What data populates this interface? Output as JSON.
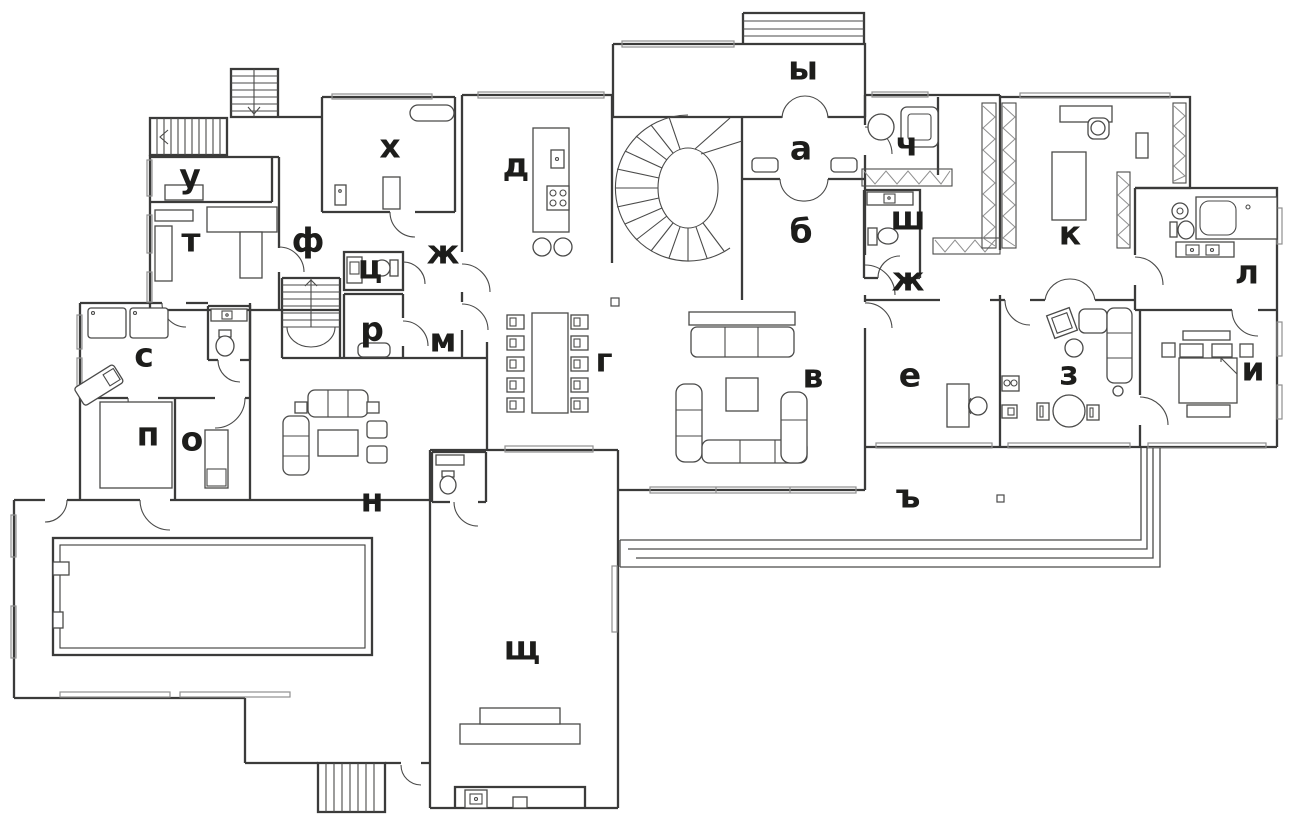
{
  "style": {
    "background": "#ffffff",
    "wall_color": "#3b3b3a",
    "furniture_color": "#4a4a49",
    "window_color": "#8f8f8f",
    "label_color": "#1d1d1b",
    "label_font_size": "33px"
  },
  "plan_type": "floor-plan",
  "rooms": [
    {
      "letter": "ы",
      "x": 803,
      "y": 68
    },
    {
      "letter": "а",
      "x": 801,
      "y": 148
    },
    {
      "letter": "б",
      "x": 801,
      "y": 231
    },
    {
      "letter": "ч",
      "x": 907,
      "y": 144
    },
    {
      "letter": "ш",
      "x": 908,
      "y": 218
    },
    {
      "letter": "ж",
      "x": 908,
      "y": 279
    },
    {
      "letter": "к",
      "x": 1070,
      "y": 233
    },
    {
      "letter": "л",
      "x": 1247,
      "y": 272
    },
    {
      "letter": "х",
      "x": 390,
      "y": 146
    },
    {
      "letter": "д",
      "x": 516,
      "y": 165
    },
    {
      "letter": "у",
      "x": 190,
      "y": 176
    },
    {
      "letter": "т",
      "x": 191,
      "y": 240
    },
    {
      "letter": "ф",
      "x": 308,
      "y": 240
    },
    {
      "letter": "ц",
      "x": 370,
      "y": 267
    },
    {
      "letter": "ж",
      "x": 443,
      "y": 252
    },
    {
      "letter": "р",
      "x": 372,
      "y": 329
    },
    {
      "letter": "м",
      "x": 443,
      "y": 340
    },
    {
      "letter": "г",
      "x": 604,
      "y": 360
    },
    {
      "letter": "в",
      "x": 813,
      "y": 376
    },
    {
      "letter": "е",
      "x": 910,
      "y": 375
    },
    {
      "letter": "з",
      "x": 1069,
      "y": 373
    },
    {
      "letter": "и",
      "x": 1253,
      "y": 369
    },
    {
      "letter": "с",
      "x": 144,
      "y": 355
    },
    {
      "letter": "п",
      "x": 148,
      "y": 434
    },
    {
      "letter": "о",
      "x": 192,
      "y": 439
    },
    {
      "letter": "н",
      "x": 372,
      "y": 500
    },
    {
      "letter": "щ",
      "x": 522,
      "y": 648
    },
    {
      "letter": "ъ",
      "x": 908,
      "y": 496
    }
  ]
}
